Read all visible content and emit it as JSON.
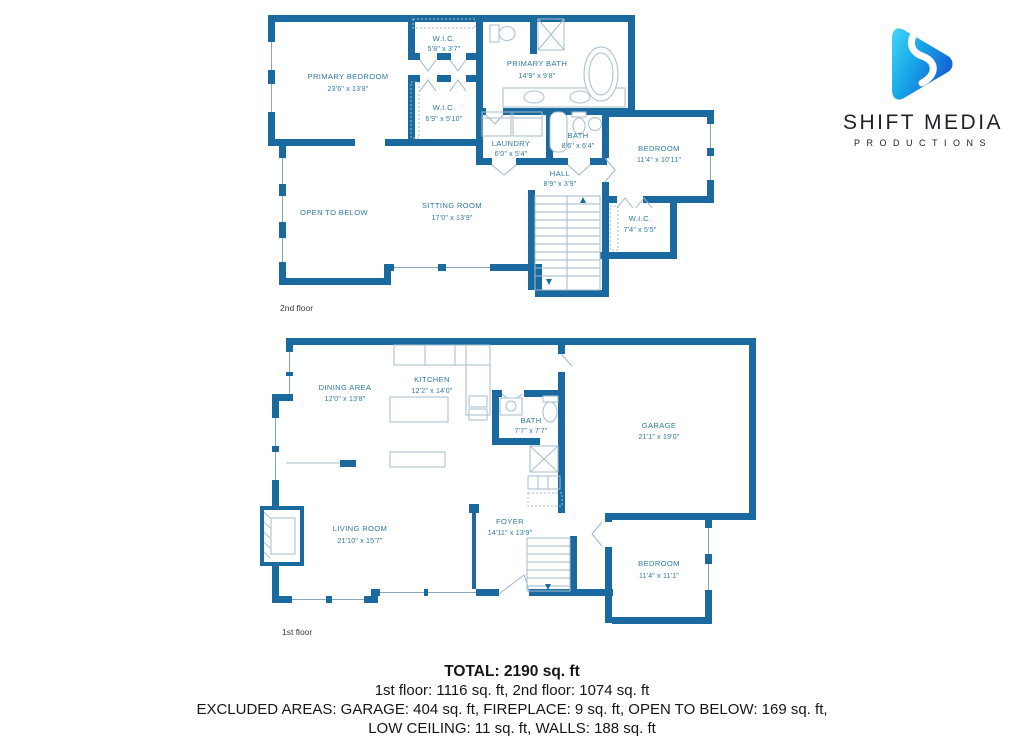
{
  "logo": {
    "brand": "SHIFT MEDIA",
    "sub": "PRODUCTIONS"
  },
  "floors": {
    "second": {
      "label": "2nd floor",
      "rooms": [
        {
          "name": "W.I.C.",
          "dims": "5'8\" x 3'7\""
        },
        {
          "name": "PRIMARY BEDROOM",
          "dims": "23'6\" x 13'8\""
        },
        {
          "name": "PRIMARY BATH",
          "dims": "14'9\" x 9'8\""
        },
        {
          "name": "W.I.C.",
          "dims": "6'9\" x 5'10\""
        },
        {
          "name": "LAUNDRY",
          "dims": "6'0\" x 5'4\""
        },
        {
          "name": "BATH",
          "dims": "8'6\" x 6'4\""
        },
        {
          "name": "BEDROOM",
          "dims": "11'4\" x 10'11\""
        },
        {
          "name": "HALL",
          "dims": "8'9\" x 3'9\""
        },
        {
          "name": "SITTING ROOM",
          "dims": "17'0\" x 13'9\""
        },
        {
          "name": "W.I.C.",
          "dims": "7'4\" x 5'5\""
        },
        {
          "name": "OPEN TO BELOW",
          "dims": ""
        }
      ]
    },
    "first": {
      "label": "1st floor",
      "rooms": [
        {
          "name": "KITCHEN",
          "dims": "12'2\" x 14'0\""
        },
        {
          "name": "DINING AREA",
          "dims": "12'0\" x 13'8\""
        },
        {
          "name": "BATH",
          "dims": "7'7\" x 7'7\""
        },
        {
          "name": "GARAGE",
          "dims": "21'1\" x 19'0\""
        },
        {
          "name": "LIVING ROOM",
          "dims": "21'10\" x 15'7\""
        },
        {
          "name": "FOYER",
          "dims": "14'11\" x 13'9\""
        },
        {
          "name": "BEDROOM",
          "dims": "11'4\" x 11'1\""
        }
      ]
    }
  },
  "summary": {
    "total": "TOTAL: 2190 sq. ft",
    "line2": "1st floor: 1116 sq. ft, 2nd floor: 1074 sq. ft",
    "line3": "EXCLUDED AREAS: GARAGE: 404 sq. ft, FIREPLACE: 9 sq. ft, OPEN TO BELOW: 169 sq. ft,",
    "line4": "LOW CEILING: 11 sq. ft, WALLS: 188 sq. ft"
  },
  "colors": {
    "wall": "#1a6a9f",
    "room_text": "#2f7aa4",
    "fixture": "#a6bece",
    "logo_cyan": "#45d7f7",
    "logo_blue": "#1560d6",
    "logo_text": "#212129"
  }
}
